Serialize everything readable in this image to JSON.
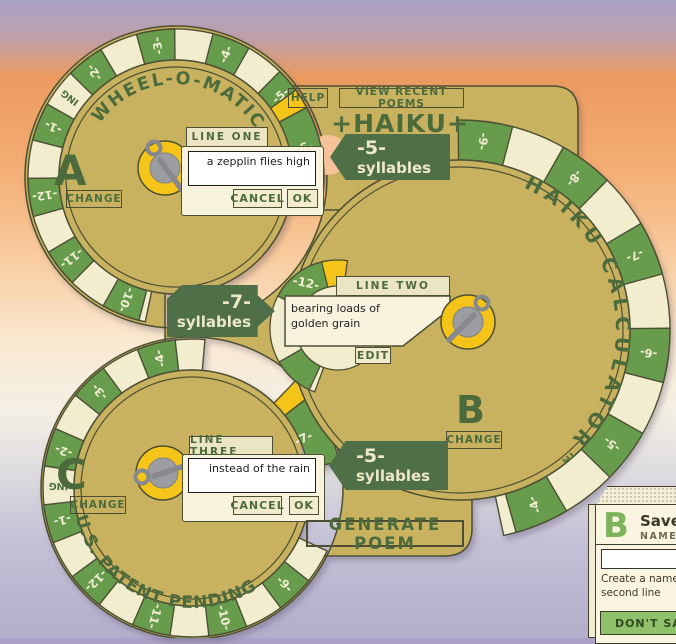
{
  "app": {
    "title": "+HAIKU+"
  },
  "toolbar": {
    "help": "HELP",
    "view_recent": "VIEW RECENT POEMS",
    "generate": "GENERATE POEM"
  },
  "wheels": [
    {
      "id": "A",
      "letter": "A",
      "ring_title": "WHEEL-O-MATIC",
      "change": "CHANGE",
      "position": "-6-",
      "line_tab": "LINE ONE",
      "line_text": "a zepplin flies high",
      "cancel": "CANCEL",
      "ok": "OK",
      "numbers": [
        "-3-",
        "-4-",
        "-5-",
        "-10-",
        "-11-",
        "-12-",
        "-1-",
        "-2-",
        "ING"
      ]
    },
    {
      "id": "B",
      "letter": "B",
      "ring_title": "HAIKU CALCULATOR™",
      "change": "CHANGE",
      "position": "-12-",
      "line_tab": "LINE TWO",
      "line_text": "bearing loads of golden grain",
      "edit": "EDIT",
      "numbers": [
        "-9-",
        "-8-",
        "-7-",
        "-6-",
        "-5-",
        "-4-"
      ]
    },
    {
      "id": "C",
      "letter": "C",
      "ring_title": "U.S. PATENT PENDING",
      "change": "CHANGE",
      "position": "-7-",
      "line_tab": "LINE THREE",
      "line_text": "instead of the rain",
      "cancel": "CANCEL",
      "ok": "OK",
      "numbers": [
        "-9-",
        "-10-",
        "-11-",
        "-12-",
        "-1-",
        "-2-",
        "-3-",
        "-4-",
        "ING"
      ]
    }
  ],
  "badges": [
    {
      "count": "-5-",
      "label": "syllables",
      "points": "left"
    },
    {
      "count": "-7-",
      "label": "syllables",
      "points": "right"
    },
    {
      "count": "-5-",
      "label": "syllables",
      "points": "left"
    }
  ],
  "save_dialog": {
    "letter": "B",
    "title": "Save",
    "name_label": "NAME",
    "input_value": "",
    "helper_line1": "Create a name for",
    "helper_line2": "second line",
    "dont_save": "DON'T SAVE"
  },
  "colors": {
    "tan": "#c8b260",
    "outline": "#4c4f33",
    "dark_green": "#4c6b3c",
    "badge_green": "#4e6f47",
    "badge_text": "#eee8c8",
    "ring_green": "#679c4d",
    "ring_cream": "#f3edcf",
    "number_text": "#f2ecd2",
    "hub_yellow": "#f4c418",
    "hub_gray": "#9b9da0",
    "pin_gray": "#87898c",
    "bubble_cream": "#f8f3dc",
    "peach_disc": "#f5c29a",
    "gray_disc": "#a7a8ab"
  }
}
